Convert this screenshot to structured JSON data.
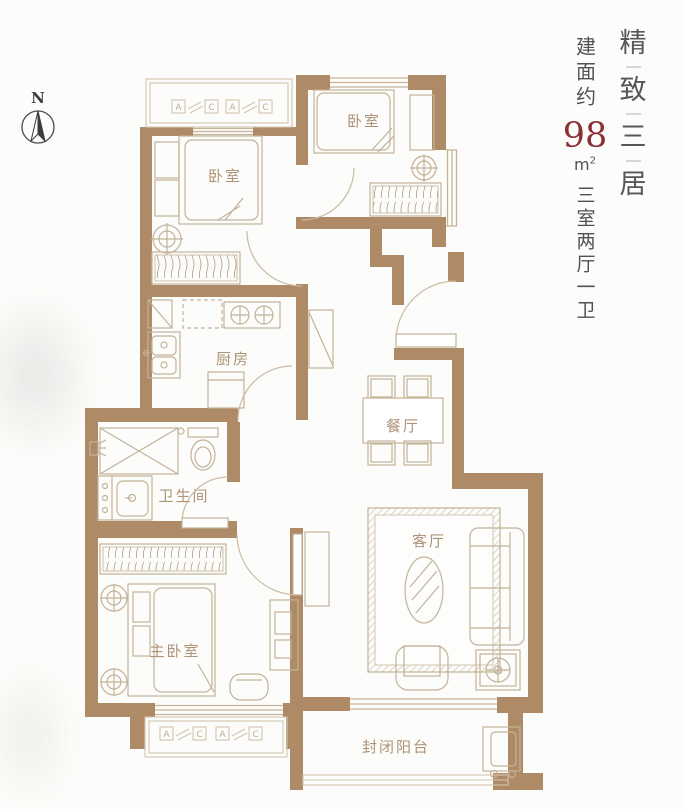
{
  "compass": {
    "north": "N"
  },
  "title": {
    "chars": [
      "精",
      "致",
      "三",
      "居"
    ]
  },
  "spec": {
    "area_prefix": "建面约",
    "area_value": "98",
    "unit_base": "m",
    "unit_exp": "2",
    "layout_desc": "三室两厅一卫"
  },
  "rooms": {
    "bedroom_left": "卧室",
    "bedroom_right": "卧室",
    "kitchen": "厨房",
    "dining": "餐厅",
    "bathroom": "卫生间",
    "master_bedroom": "主卧室",
    "living_room": "客厅",
    "balcony": "封闭阳台"
  },
  "ac_marker": {
    "a": "A",
    "c": "C"
  },
  "colors": {
    "wall": "#ae8b66",
    "furniture_line": "#c3b299",
    "room_label": "#ad9377",
    "title_text": "#56575b",
    "area_red": "#8a3136"
  }
}
